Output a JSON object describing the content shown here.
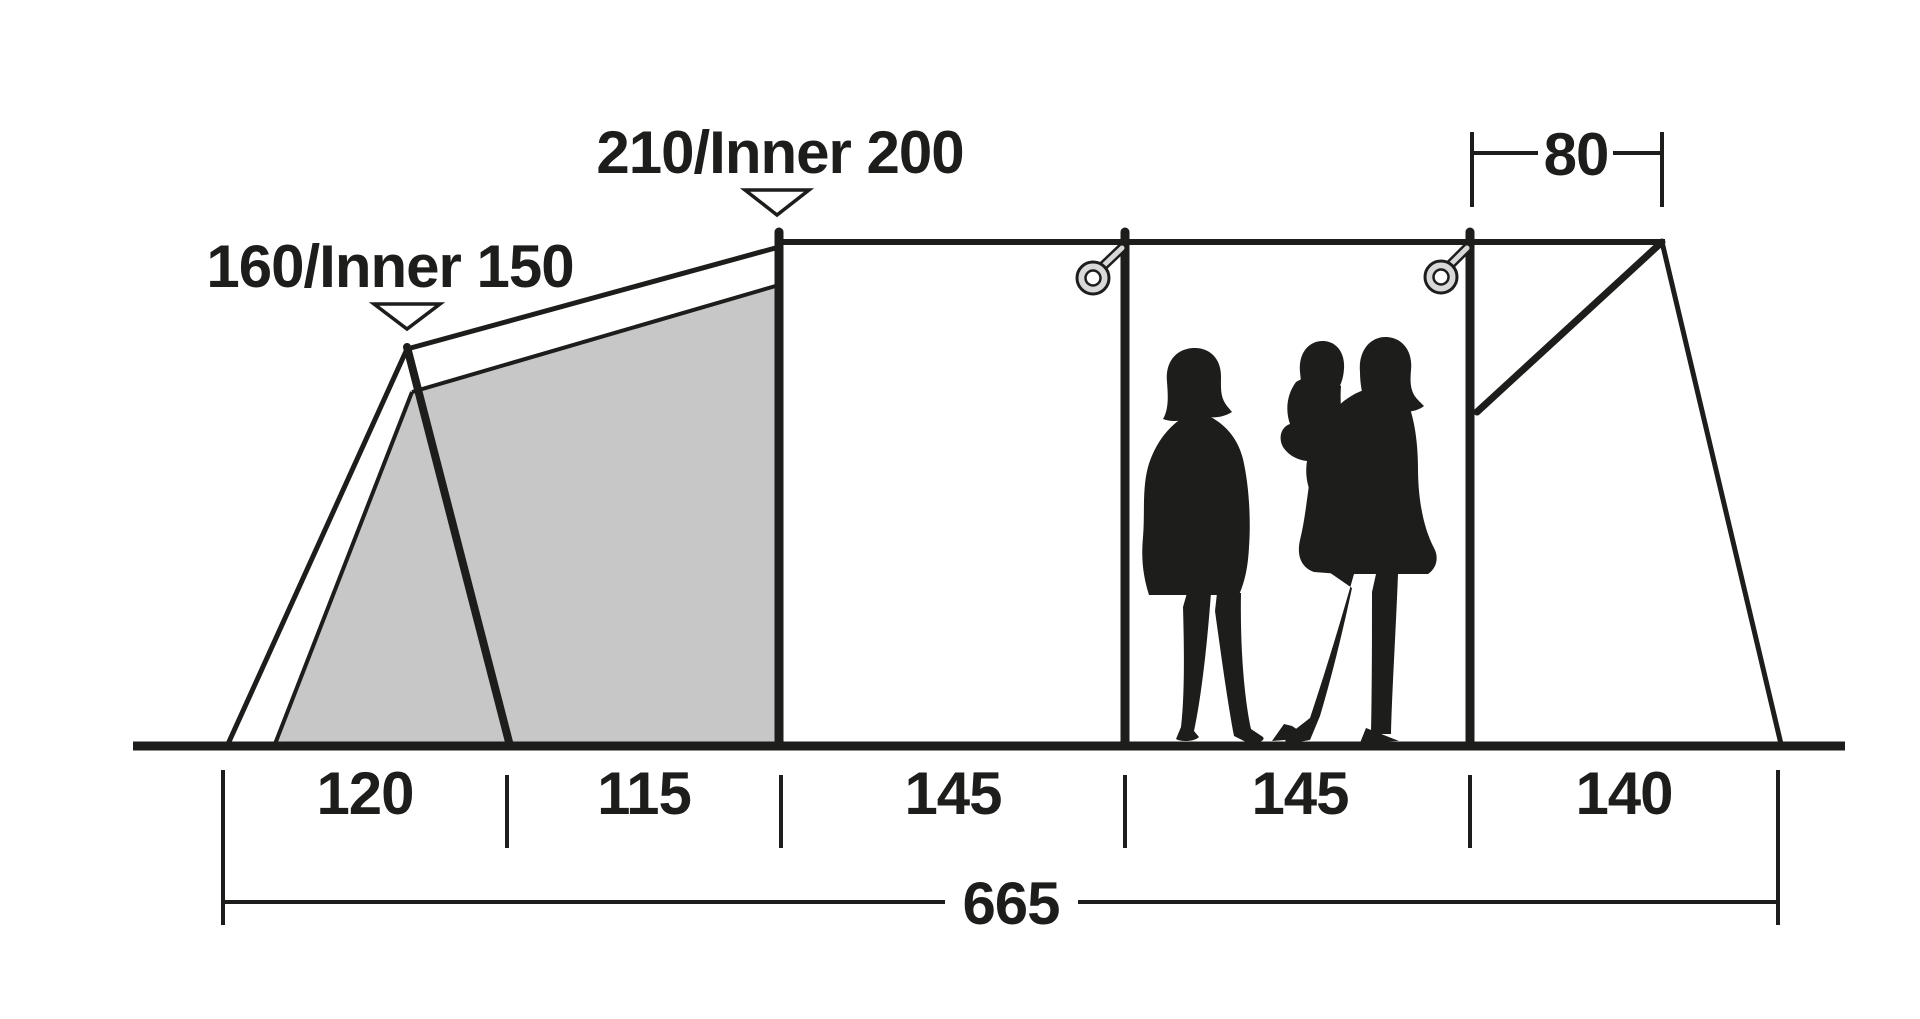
{
  "diagram": {
    "type": "tent-side-profile-dimension-diagram",
    "colors": {
      "ink": "#1d1d1b",
      "inner_tent_fill": "#c7c7c7",
      "ring_fill": "#d9d9d9",
      "background": "#ffffff"
    },
    "height_labels": {
      "front_peak": "160/Inner 150",
      "main_peak": "210/Inner 200"
    },
    "top_dimension": "80",
    "section_dimensions": [
      "120",
      "115",
      "145",
      "145",
      "140"
    ],
    "total_dimension": "665",
    "icons": {
      "peak_marker": "triangle-down-marker-icon",
      "pole_ring": "guy-ring-icon",
      "figures": "family-silhouette"
    }
  }
}
